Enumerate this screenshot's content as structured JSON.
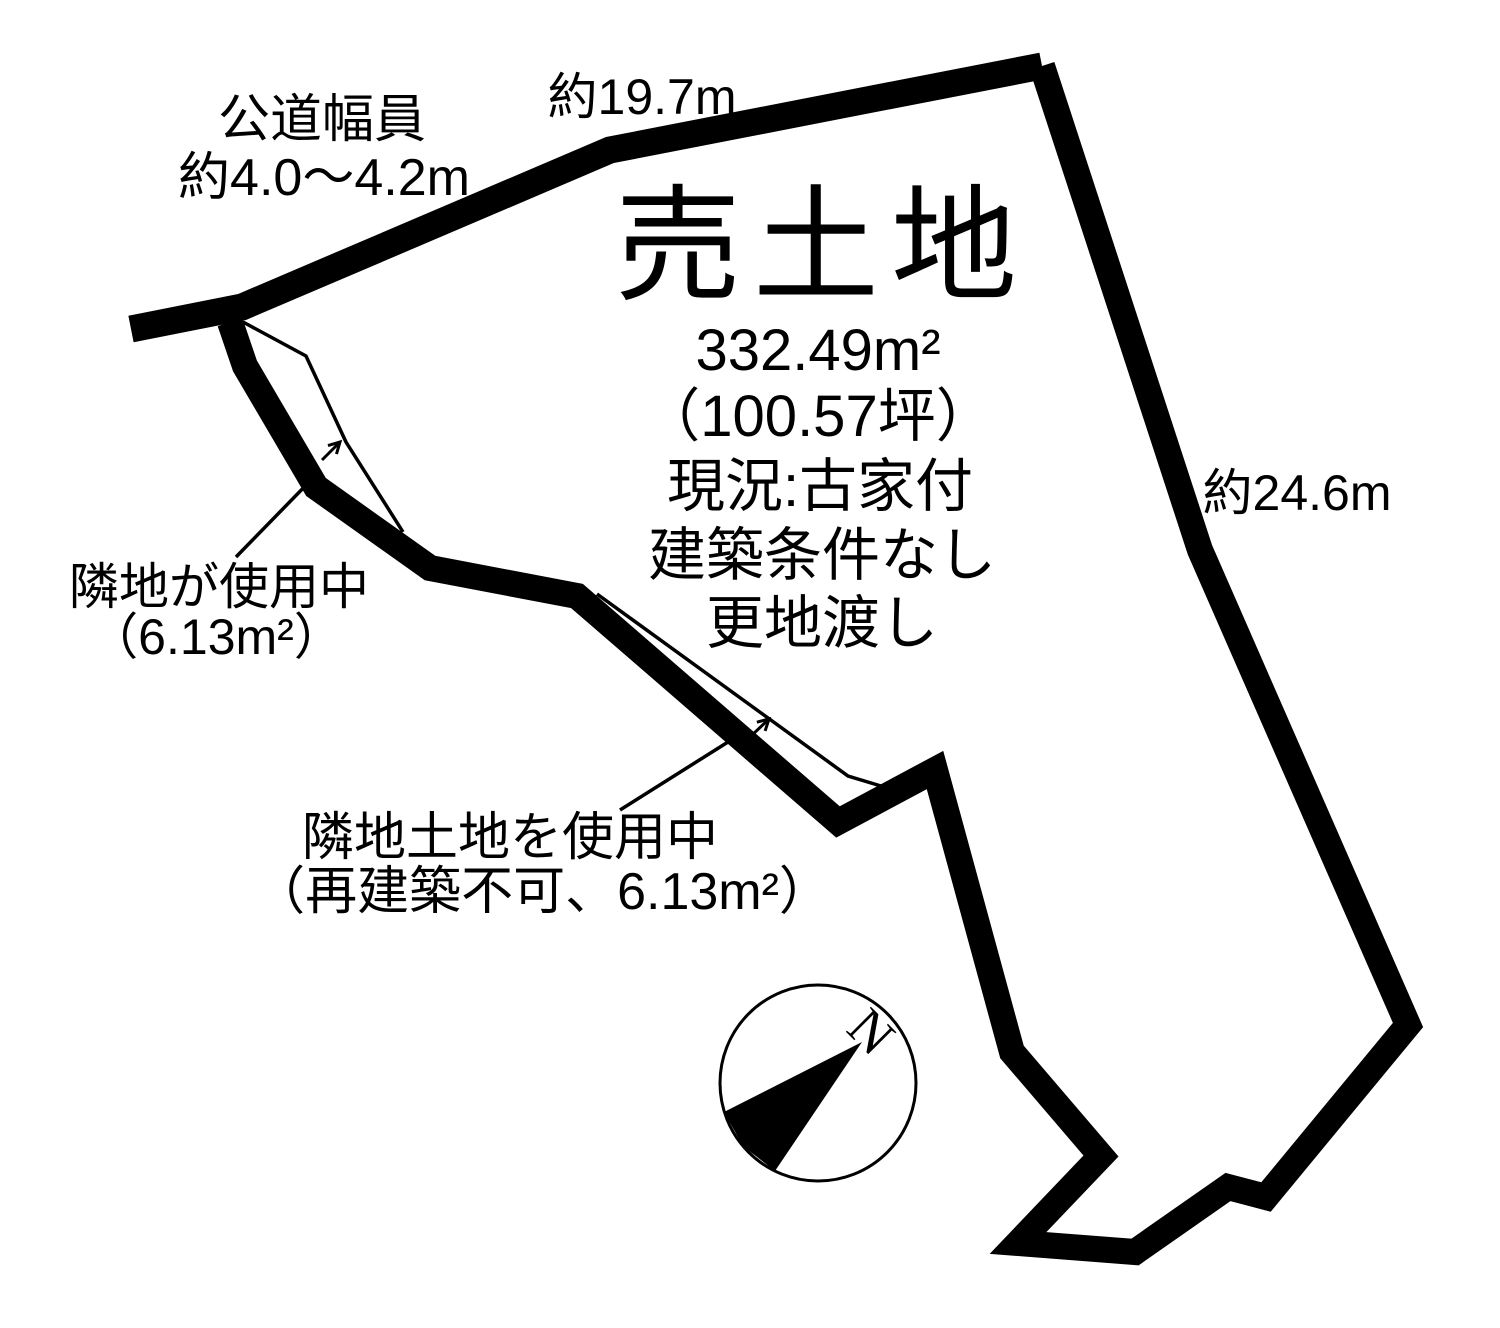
{
  "diagram": {
    "title": "売土地",
    "area_sqm": "332.49m²",
    "area_tsubo": "（100.57坪）",
    "current_status": "現況:古家付",
    "building_condition": "建築条件なし",
    "handover": "更地渡し",
    "top_edge_length": "約19.7m",
    "right_edge_length": "約24.6m",
    "road_width_label": "公道幅員",
    "road_width_value": "約4.0〜4.2m",
    "encroachment_left": {
      "line1": "隣地が使用中",
      "line2": "（6.13m²）"
    },
    "encroachment_bottom": {
      "line1": "隣地土地を使用中",
      "line2": "（再建築不可、6.13m²）"
    },
    "compass": {
      "north_label": "N"
    },
    "colors": {
      "ink": "#000000",
      "background": "#ffffff"
    }
  }
}
